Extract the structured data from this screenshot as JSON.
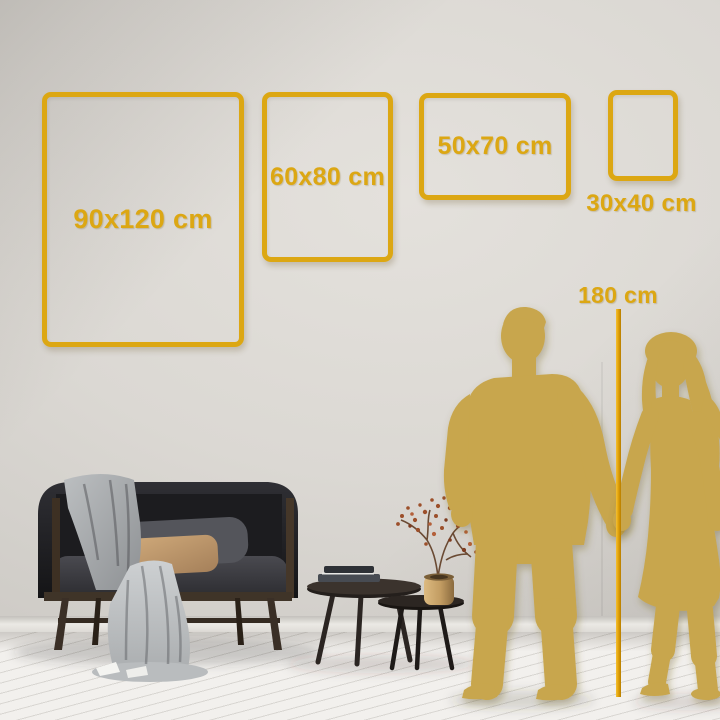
{
  "scene": {
    "name": "poster-size-guide",
    "frames": [
      {
        "size": "90x120",
        "label": "90x120 cm"
      },
      {
        "size": "60x80",
        "label": "60x80 cm"
      },
      {
        "size": "50x70",
        "label": "50x70 cm"
      },
      {
        "size": "30x40",
        "label": "30x40 cm"
      }
    ],
    "height_marker": {
      "label": "180 cm"
    },
    "icons": {
      "man": "man-standing-silhouette",
      "woman": "woman-standing-silhouette",
      "furniture": [
        "sofa",
        "blanket",
        "coffee-tables",
        "books",
        "vase-with-branch"
      ]
    },
    "colors": {
      "frame_gold": "#DCA713",
      "silhouette_gold": "#C8A64D",
      "measure_line_gold": "#DD9C04",
      "wall": "#DAD7D2",
      "floor": "#F2F0ED"
    }
  }
}
